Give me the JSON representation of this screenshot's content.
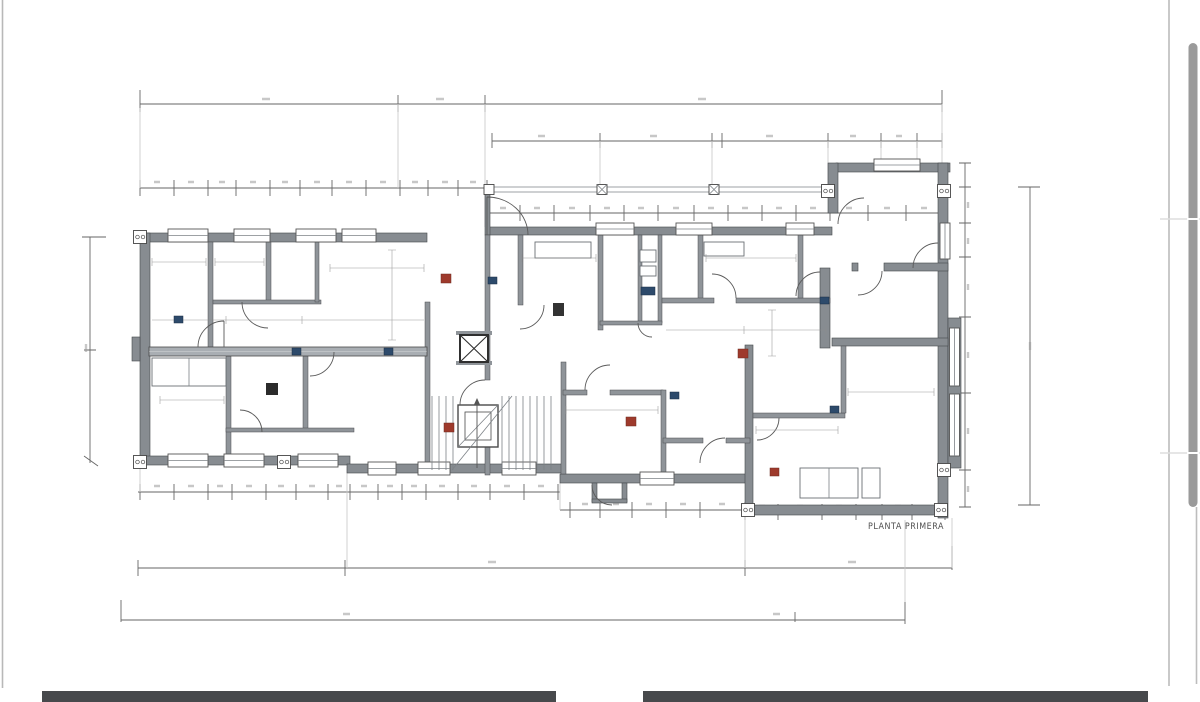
{
  "page": {
    "background": "#ffffff",
    "left_edge_line_color": "#b8b8b8",
    "right_edge_line_color": "#b2b2b2",
    "scrollbar": {
      "thumb_color": "#9a9a9a",
      "track_line_color": "#bdbdbd"
    },
    "bottom_bars": {
      "color": "#47494c"
    }
  },
  "drawing": {
    "title": "PLANTA PRIMERA",
    "type": "architectural floor plan",
    "wall_fill": "#878c91",
    "interior_wall_fill": "#8f9499",
    "corridor_fill": "#a9aeb3",
    "dimension_line_color": "#666666",
    "marker_colors": {
      "blue": "#2d4a6b",
      "red": "#9e3a2c"
    }
  }
}
